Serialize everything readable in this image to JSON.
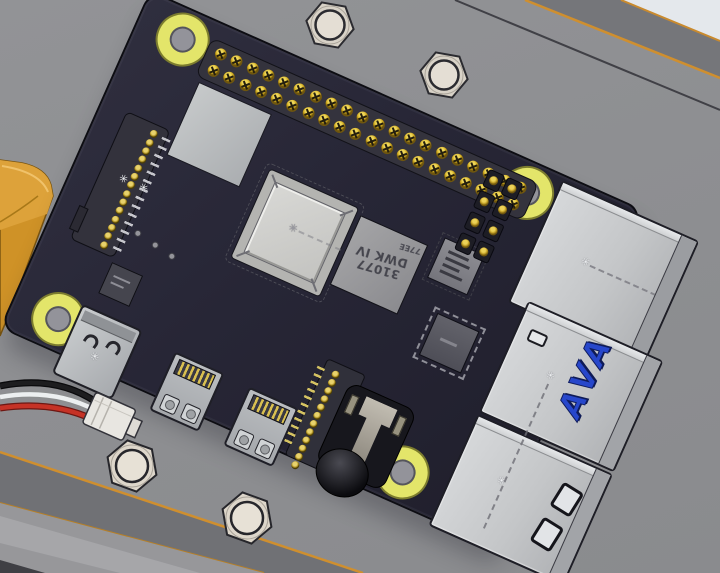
{
  "view": {
    "description": "3D CAD assembly view: Raspberry Pi style single-board computer on a gray mounting plate with hex standoffs"
  },
  "board": {
    "ram_chip_marking_line1": "31077",
    "ram_chip_marking_line2": "DWK IV",
    "ram_chip_marking_corner": "77EE",
    "usb_port_marking": "AVA"
  },
  "markers": {
    "sketch_point": "✳"
  },
  "counts": {
    "mount_holes": 4,
    "standoff_nuts": 4,
    "gpio_rows": 2,
    "gpio_cols": 20,
    "dsi_pins": 14,
    "csi_pins": 12,
    "aux_header_rows": 4,
    "aux_header_cols": 2,
    "silkscreen_dots": 3,
    "wire_count": 3
  },
  "colors": {
    "plate": "#8e8f92",
    "pcb": "#262534",
    "mount_hole_ring": "#e3e56a",
    "standoff": "#d8d2c7",
    "orange_part": "#d5992c",
    "usb_logo_blue": "#2747cb",
    "pin_gold": "#cfa91f",
    "edge_highlight_orange": "#cf8f2f",
    "wire_red": "#c63226",
    "wire_white": "#eceff0",
    "wire_black": "#1d1d1f"
  }
}
